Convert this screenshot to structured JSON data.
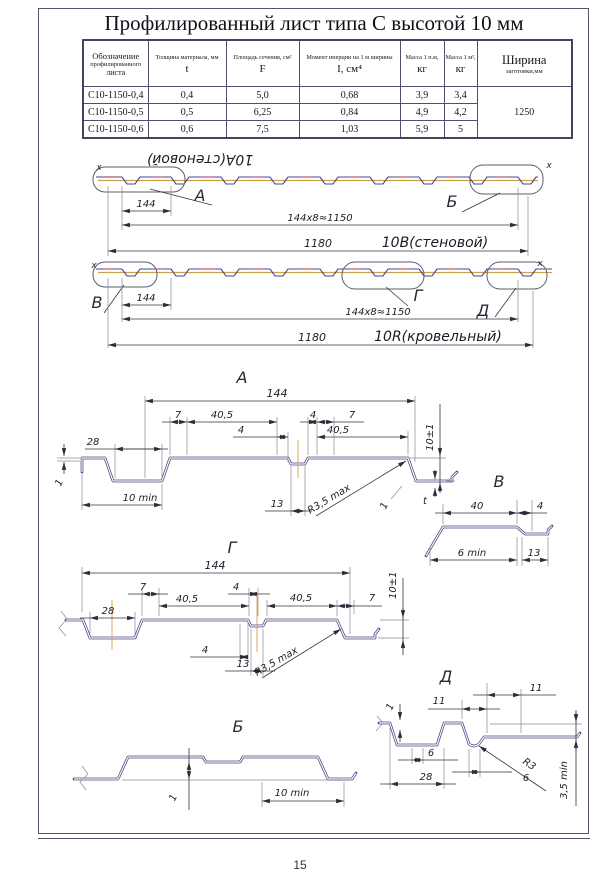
{
  "page_number": "15",
  "title": "Профилированный лист типа С высотой 10 мм",
  "table": {
    "col1_header": [
      "Обозначение",
      "профилированного",
      "листа"
    ],
    "cols": [
      {
        "desc": "Толщина материала, мм",
        "sym": "t"
      },
      {
        "desc": "Площадь сечения, см²",
        "sym": "F"
      },
      {
        "desc": "Момент инерции на 1 м ширины",
        "sym": "I, см⁴"
      },
      {
        "desc": "Масса 1 п.м,",
        "sym": "кг"
      },
      {
        "desc": "Масса 1 м²,",
        "sym": "кг"
      }
    ],
    "width_header": {
      "line1": "Ширина",
      "line2": "заготовки,мм"
    },
    "rows": [
      {
        "name": "С10-1150-0,4",
        "t": "0,4",
        "f": "5,0",
        "i": "0,68",
        "m1": "3,9",
        "m2": "3,4"
      },
      {
        "name": "С10-1150-0,5",
        "t": "0,5",
        "f": "6,25",
        "i": "0,84",
        "m1": "4,9",
        "m2": "4,2"
      },
      {
        "name": "С10-1150-0,6",
        "t": "0,6",
        "f": "7,5",
        "i": "1,03",
        "m1": "5,9",
        "m2": "5"
      }
    ],
    "blank_width": "1250"
  },
  "strips": {
    "wall": {
      "flipped_label": "10А(стеновой)",
      "label": "10В(стеновой)",
      "pitch": "144",
      "pitch_total": "144х8≈1150",
      "overall": "1180",
      "zone_a": "А",
      "zone_b": "Б",
      "axis_mark": "x"
    },
    "roof": {
      "label": "10R(кровельный)",
      "pitch": "144",
      "pitch_total": "144х8≈1150",
      "overall": "1180",
      "zone_v": "В",
      "zone_g": "Г",
      "zone_d": "Д",
      "axis_mark": "x"
    }
  },
  "details": {
    "a": {
      "title": "А",
      "overall": "144",
      "d28": "28",
      "d7a": "7",
      "d405a": "40,5",
      "d4a": "4",
      "d7b": "7",
      "d4b": "4",
      "d405b": "40,5",
      "d13": "13",
      "d10min": "10 min",
      "d1a": "1",
      "d1b": "1",
      "radius": "R3,5 max",
      "height": "10±1",
      "t": "t"
    },
    "v": {
      "title": "В",
      "d40": "40",
      "d4": "4",
      "d6min": "6 min",
      "d13": "13"
    },
    "g": {
      "title": "Г",
      "overall": "144",
      "d28": "28",
      "d7a": "7",
      "d405a": "40,5",
      "d4a": "4",
      "d405b": "40,5",
      "d7b": "7",
      "d4b": "4",
      "d13": "13",
      "height": "10±1",
      "radius": "R3,5 max"
    },
    "d": {
      "title": "Д",
      "d1": "1",
      "d11a": "11",
      "d11b": "11",
      "d6a": "6",
      "d28": "28",
      "d6b": "6",
      "radius": "R3",
      "height": "3,5 min"
    },
    "b": {
      "title": "Б",
      "d1": "1",
      "d10min": "10 min"
    }
  }
}
